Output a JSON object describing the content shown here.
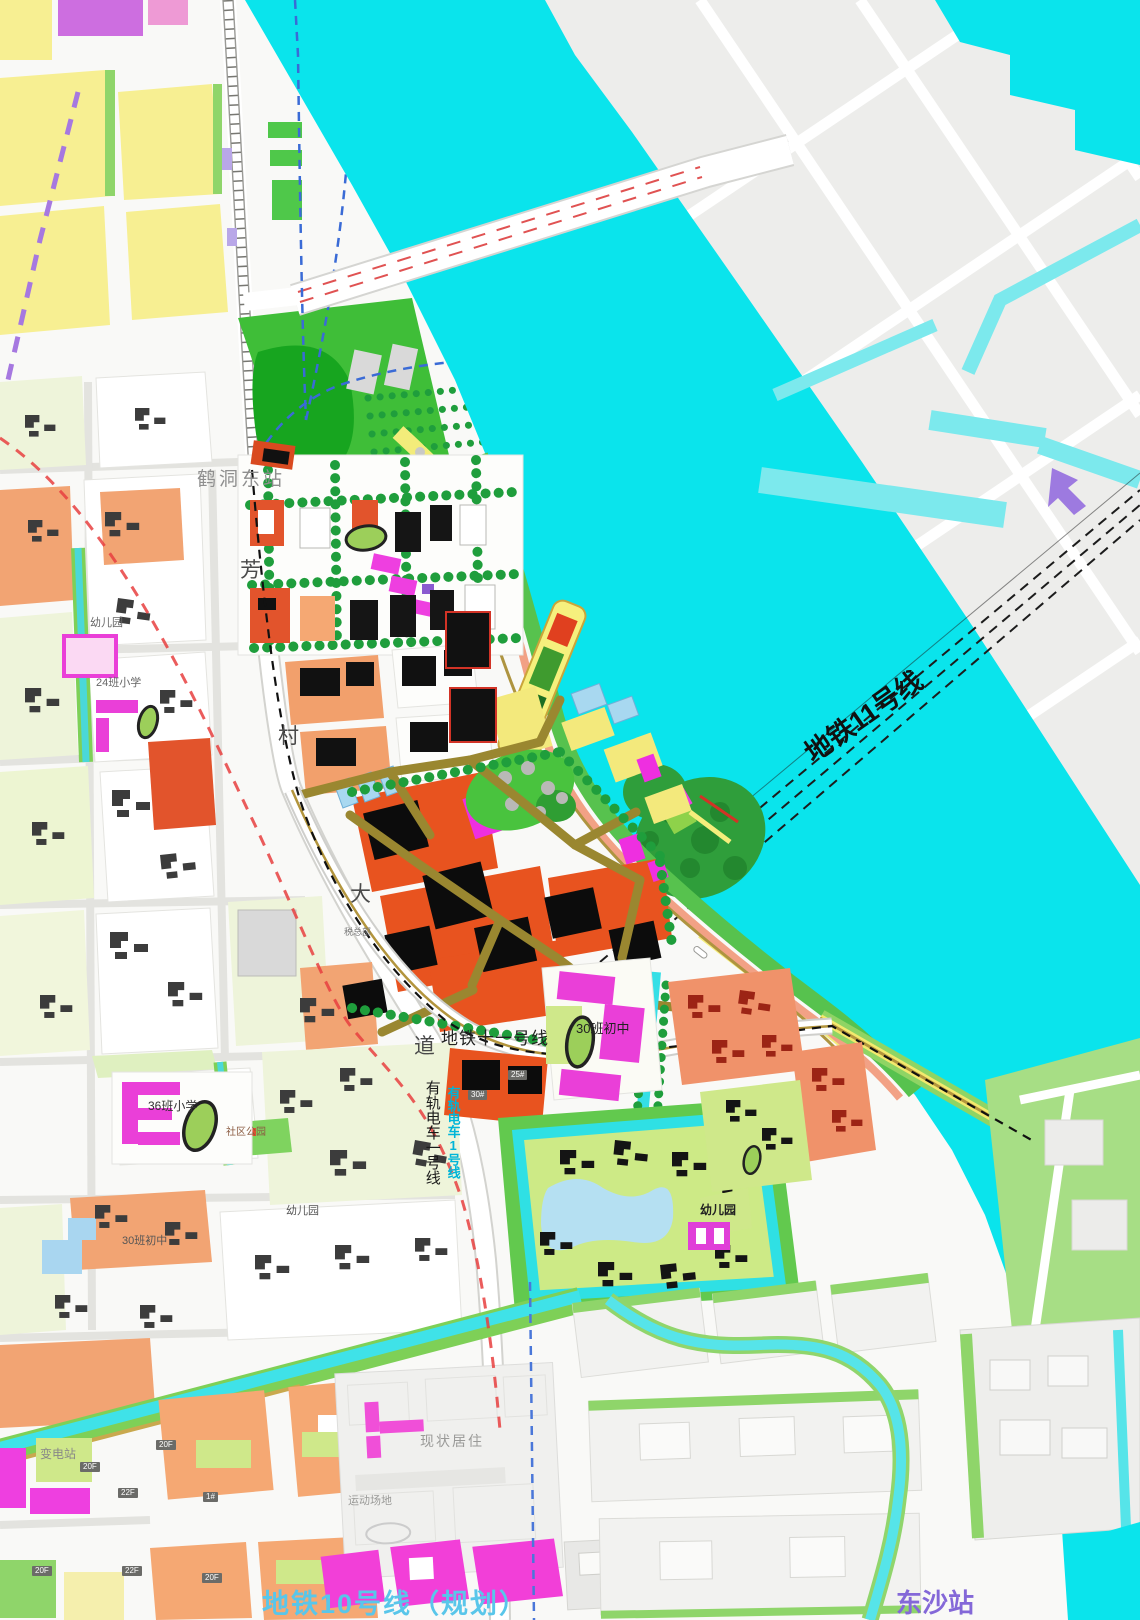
{
  "colors": {
    "river": "#0ae4ec",
    "canalLight": "#7ce9ed",
    "landGray": "#ededeb",
    "parkGreen": "#3fbe38",
    "edgeGreen": "#8fd56a",
    "yellowParcel": "#f7ef92",
    "orangeParcel": "#f5a873",
    "coreOrange": "#e8531f",
    "magenta": "#ee3fe0",
    "oliveRoad": "#9a8730",
    "salmonRoad": "#f2a185",
    "treeGreen": "#1f9e3c",
    "metroBlue": "#4a77d9",
    "boundaryRed": "#e84040",
    "tramCyanText": "#00b5d8",
    "metro10Text": "#59c6ea",
    "purpleText": "#8468d8"
  },
  "labels": {
    "hedong_east_station": {
      "text": "鹤洞东站"
    },
    "fangcun_avenue": [
      "芳",
      "村",
      "大",
      "道"
    ],
    "metro11_diag": {
      "text": "地铁11号线"
    },
    "metro11_road": {
      "text": "地铁十一号线"
    },
    "tram1_cyan": {
      "text": "有轨电车1号线"
    },
    "tram1_black": {
      "text": "有轨电车一号线"
    },
    "metro10": {
      "text": "地铁10号线（规划）"
    },
    "dongsha_station": {
      "text": "东沙站"
    },
    "middle_school_30": {
      "text": "30班初中"
    },
    "middle_school_30_west": {
      "text": "30班初中"
    },
    "primary_school_36": {
      "text": "36班小学"
    },
    "primary_school_24": {
      "text": "24班小学"
    },
    "kindergarten_nw": {
      "text": "幼儿园"
    },
    "kindergarten_sw": {
      "text": "幼儿园"
    },
    "kindergarten_se": {
      "text": "幼儿园"
    },
    "substation": {
      "text": "变电站"
    },
    "existing_residential": {
      "text": "现状居住"
    },
    "sports_ground": {
      "text": "运动场地"
    },
    "community_park": {
      "text": "社区公园"
    },
    "tax_hq": {
      "text": "税总部"
    }
  },
  "badges": [
    {
      "text": "20F"
    },
    {
      "text": "22F"
    },
    {
      "text": "20F"
    },
    {
      "text": "1#"
    },
    {
      "text": "20F"
    },
    {
      "text": "22F"
    },
    {
      "text": "20F"
    },
    {
      "text": "25#"
    },
    {
      "text": "30#"
    }
  ]
}
